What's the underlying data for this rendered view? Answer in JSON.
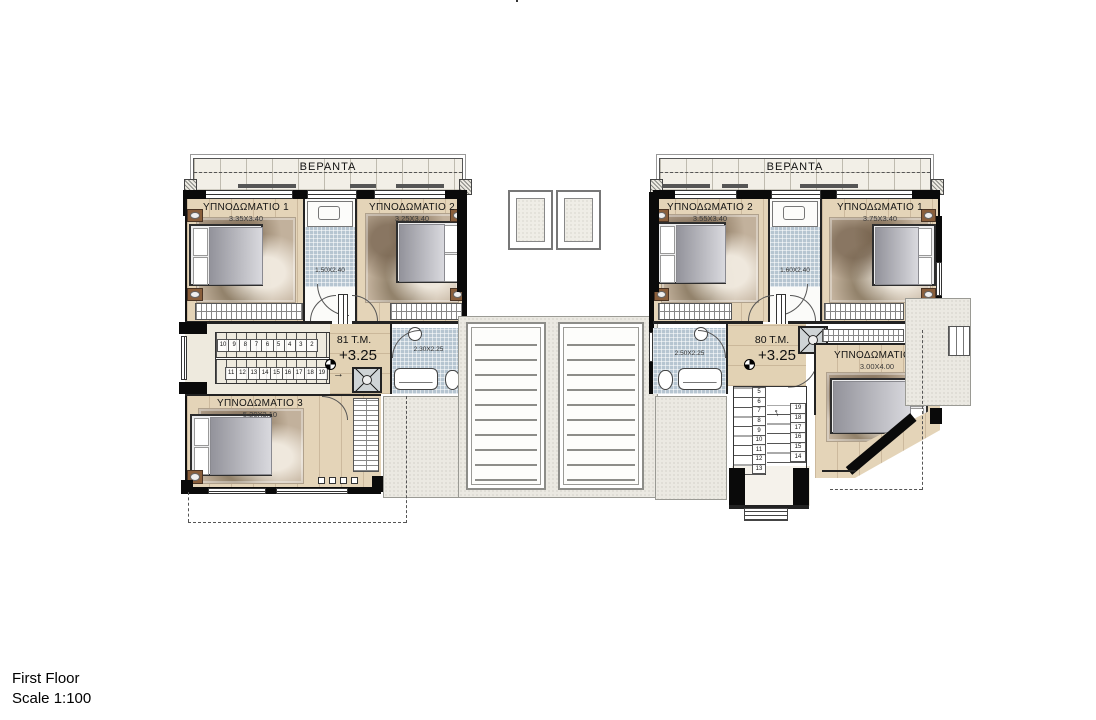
{
  "meta": {
    "title": "First Floor",
    "scale": "Scale 1:100"
  },
  "icons": {
    "stair_arrow_left_unit": "→",
    "stair_arrow_right_unit": "↑"
  },
  "colors": {
    "wall": "#0a0a0a",
    "wood_floor": "#e4d4b8",
    "bath_tile": "#b6c5d1",
    "veranda_floor": "#f2efe7",
    "terrace": "#ebe9e2",
    "rug": "#c2b19c"
  },
  "units": {
    "left": {
      "veranda_label": "ΒΕΡΑΝΤΑ",
      "area": "81 T.M.",
      "level": "+3.25",
      "bedroom1": {
        "name": "ΥΠΝΟΔΩΜΑΤΙΟ 1",
        "dims": "3.35X3.40"
      },
      "bedroom2": {
        "name": "ΥΠΝΟΔΩΜΑΤΙΟ 2",
        "dims": "3.25X3.40"
      },
      "bedroom3": {
        "name": "ΥΠΝΟΔΩΜΑΤΙΟ 3",
        "dims": "5.20X3.10"
      },
      "bath1_dims": "1.50X2.40",
      "bath2_dims": "2.30X2.25",
      "stairs_up": [
        "10",
        "9",
        "8",
        "7",
        "6",
        "5",
        "4",
        "3",
        "2"
      ],
      "stairs_down": [
        "11",
        "12",
        "13",
        "14",
        "15",
        "16",
        "17",
        "18",
        "19"
      ]
    },
    "right": {
      "veranda_label": "ΒΕΡΑΝΤΑ",
      "area": "80 T.M.",
      "level": "+3.25",
      "bedroom1": {
        "name": "ΥΠΝΟΔΩΜΑΤΙΟ 1",
        "dims": "3.75X3.40"
      },
      "bedroom2": {
        "name": "ΥΠΝΟΔΩΜΑΤΙΟ 2",
        "dims": "3.55X3.40"
      },
      "bedroom3": {
        "name": "ΥΠΝΟΔΩΜΑΤΙΟ 3",
        "dims": "3.00X4.00"
      },
      "bath1_dims": "1.60X2.40",
      "bath2_dims": "2.50X2.25",
      "stairs_col1": [
        "5",
        "6",
        "7",
        "8",
        "9",
        "10",
        "11",
        "12",
        "13"
      ],
      "stairs_col2": [
        "19",
        "18",
        "17",
        "16",
        "15",
        "14"
      ]
    }
  }
}
